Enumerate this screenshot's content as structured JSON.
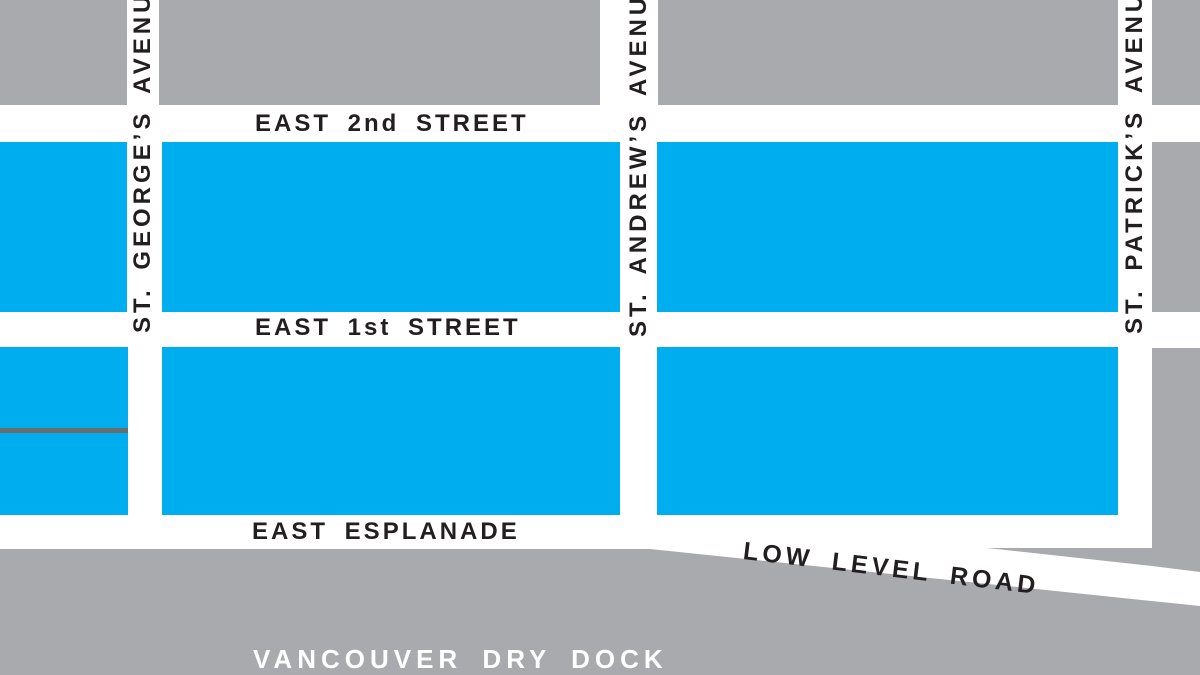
{
  "map": {
    "streets": {
      "east_2nd_street": "EAST 2nd STREET",
      "east_1st_street": "EAST 1st STREET",
      "east_esplanade": "EAST ESPLANADE",
      "low_level_road": "LOW LEVEL ROAD",
      "st_georges_avenue": "ST. GEORGE’S AVENUE",
      "st_andrews_avenue": "ST. ANDREW’S AVENUE",
      "st_patricks_avenue": "ST. PATRICK’S AVENUE"
    },
    "areas": {
      "vancouver_dry_dock": "VANCOUVER DRY DOCK"
    },
    "colors": {
      "block_gray": "#A8AAAD",
      "highlight_blue": "#00AEEF",
      "street_white": "#FFFFFF",
      "divider_dark_gray": "#6A6D70",
      "label_black": "#231F20",
      "label_white": "#FFFFFF"
    }
  }
}
